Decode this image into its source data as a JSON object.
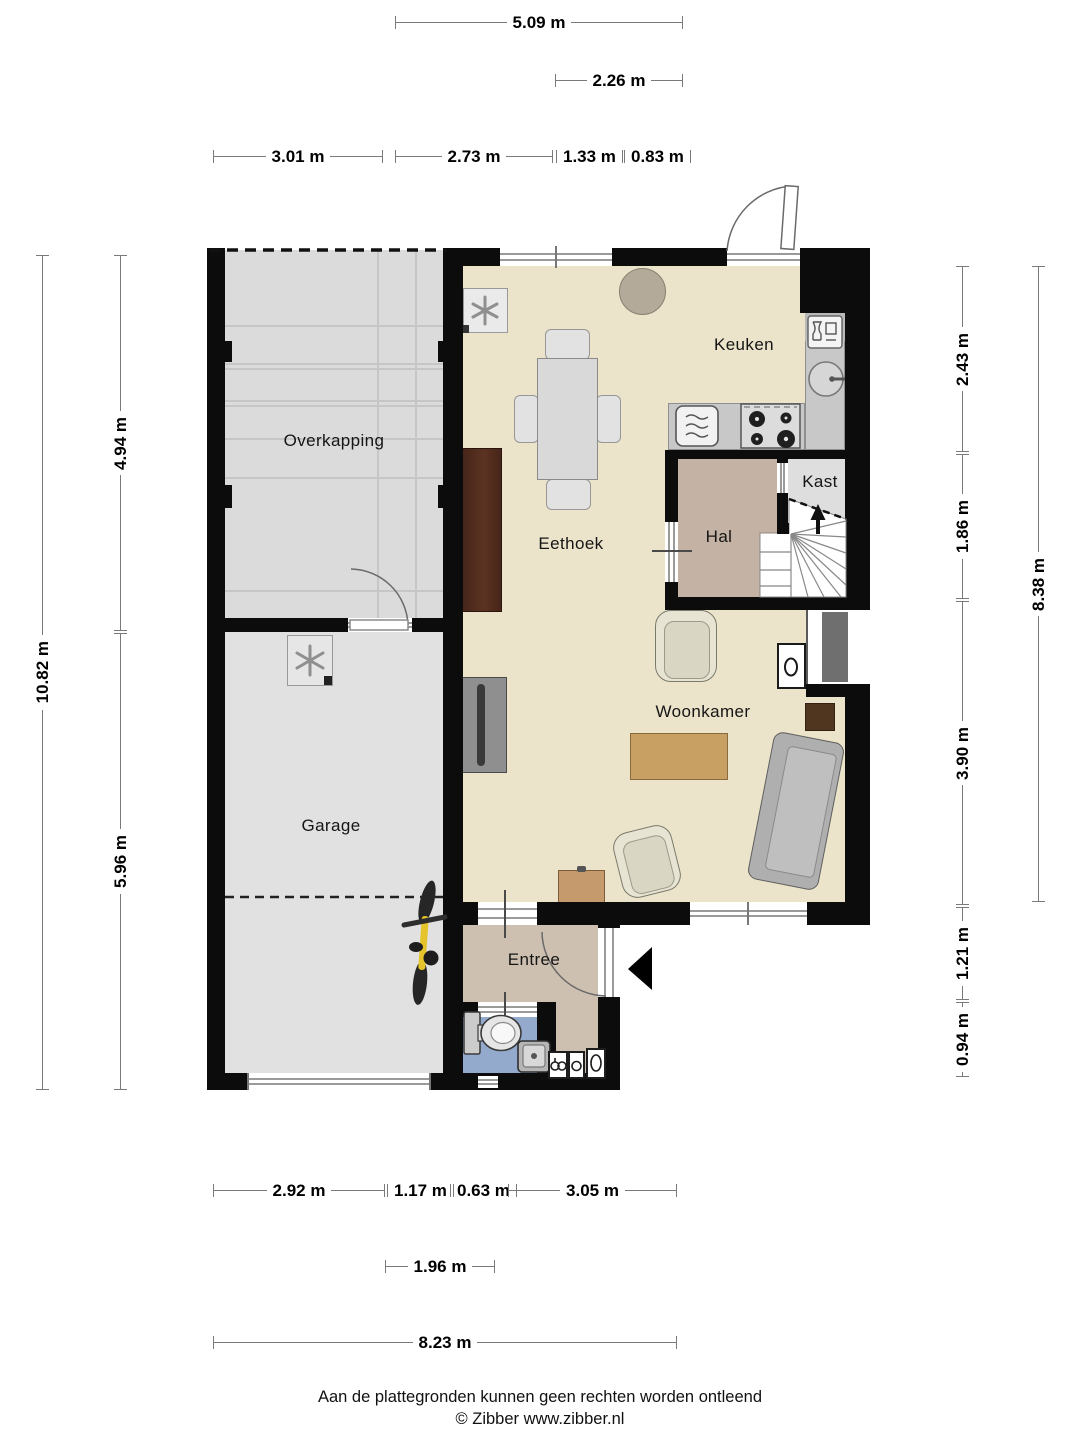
{
  "rooms": {
    "overkapping": "Overkapping",
    "garage": "Garage",
    "keuken": "Keuken",
    "eethoek": "Eethoek",
    "hal": "Hal",
    "kast": "Kast",
    "woonkamer": "Woonkamer",
    "entree": "Entree"
  },
  "dims": {
    "t_total": "5.09 m",
    "t_sub": "2.26 m",
    "t1": "3.01 m",
    "t2": "2.73 m",
    "t3": "1.33 m",
    "t4": "0.83 m",
    "l_total": "10.82 m",
    "l1": "4.94 m",
    "l2": "5.96 m",
    "r1": "2.43 m",
    "r2": "1.86 m",
    "r3": "3.90 m",
    "r4": "1.21 m",
    "r5": "0.94 m",
    "r_total": "8.38 m",
    "b1": "2.92 m",
    "b2": "1.17 m",
    "b3": "0.63 m",
    "b4": "3.05 m",
    "b_sub": "1.96 m",
    "b_total": "8.23 m"
  },
  "footer": {
    "disclaimer": "Aan de plattegronden kunnen geen rechten worden ontleend",
    "credit": "© Zibber www.zibber.nl"
  },
  "colors": {
    "wall": "#0c0c0c",
    "living_floor": "#ebe4ca",
    "garage_floor": "#e1e1e1",
    "hall_floor": "#c4b3a4",
    "entree_floor": "#cec0b0",
    "toilet_floor": "#93aacd",
    "counter": "#c8c8c8",
    "bike_accent": "#e5c32a"
  },
  "fixtures": [
    "mech-vent",
    "dining-table",
    "side-table",
    "kitchen-sink",
    "dishwasher",
    "stove",
    "microwave",
    "stairs",
    "toilet",
    "hand-basin",
    "utility-meters",
    "bicycle",
    "sofa",
    "armchair",
    "coffee-table",
    "cabinet",
    "dresser",
    "fireplace",
    "shelf"
  ]
}
